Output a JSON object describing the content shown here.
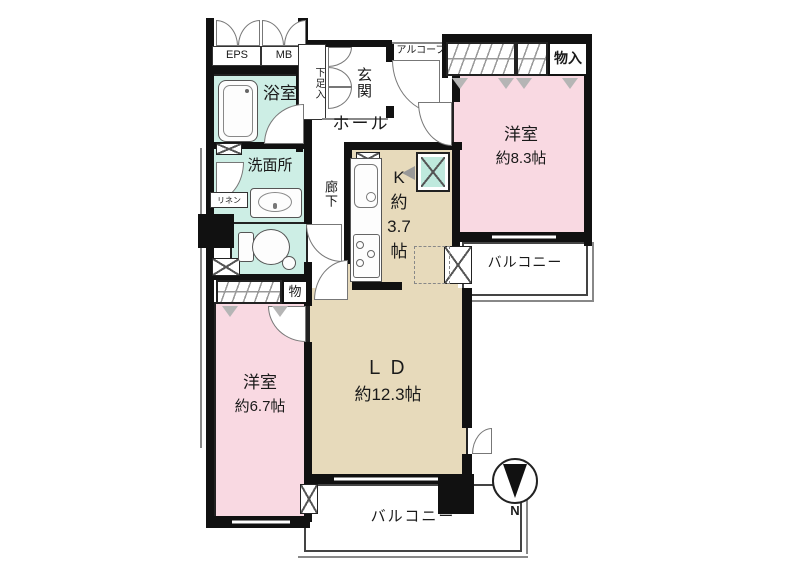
{
  "plan": {
    "labels": {
      "eps": "EPS",
      "mb": "MB",
      "bath": "浴室",
      "washroom": "洗面所",
      "linen": "リネン",
      "shoe_storage": "下足入",
      "entrance": "玄関",
      "alcove": "アルコーブ",
      "hall": "ホール",
      "corridor": "廊下",
      "storage_small": "物",
      "storage_closet": "物入",
      "kitchen_lines": [
        "K",
        "約",
        "3.7",
        "帖"
      ],
      "bedroom1_name": "洋室",
      "bedroom1_size": "約8.3帖",
      "bedroom2_name": "洋室",
      "bedroom2_size": "約6.7帖",
      "living_name": "ＬＤ",
      "living_size": "約12.3帖",
      "balcony_right": "バルコニー",
      "balcony_bottom": "バルコニー",
      "compass_north": "N"
    },
    "colors": {
      "room_pink": "#f9d9e2",
      "room_beige": "#e7dabb",
      "wet_cyan": "#cdeee5",
      "ps_cyan": "#bfe9dd",
      "wall": "#111111"
    }
  }
}
